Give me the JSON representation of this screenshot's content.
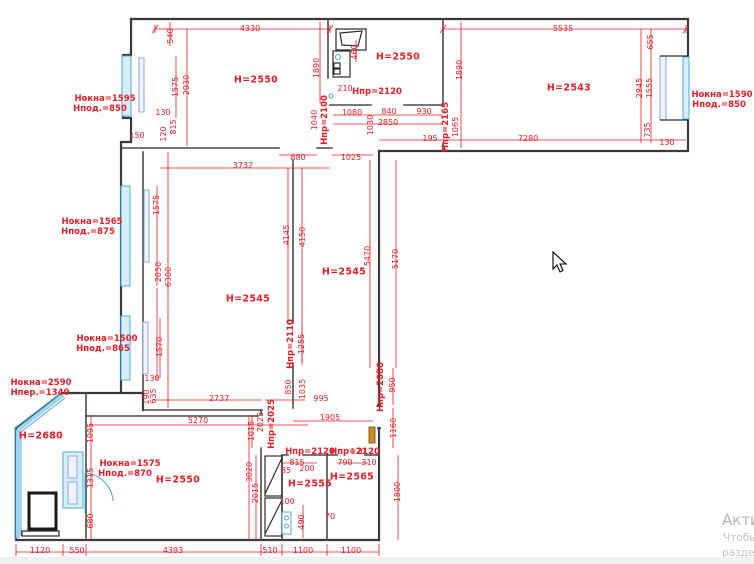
{
  "title": "apartment-measurement-floor-plan",
  "colors": {
    "dimension": "#ec1c24",
    "wall": "#3a3a3a",
    "window": "#49a8dc",
    "door_leaf": "#d28a1e",
    "watermark": "#b2b6ba"
  },
  "watermark": {
    "line1": "Актива",
    "line2": "Чтобы ак",
    "line3": "раздел \"П"
  },
  "labels": [
    [
      "4330",
      250,
      29,
      0,
      "dim"
    ],
    [
      "5535",
      563,
      29,
      0,
      "dim"
    ],
    [
      "540",
      171,
      36,
      1,
      "dim"
    ],
    [
      "655",
      651,
      42,
      1,
      "dim"
    ],
    [
      "1575",
      176,
      87,
      1,
      "dim"
    ],
    [
      "2930",
      187,
      85,
      1,
      "dim"
    ],
    [
      "H=2550",
      256,
      80,
      0,
      "room"
    ],
    [
      "1890",
      317,
      68,
      1,
      "dim"
    ],
    [
      "460",
      355,
      52,
      1,
      "dim"
    ],
    [
      "210",
      345,
      89,
      0,
      "dim"
    ],
    [
      "H=2550",
      398,
      57,
      0,
      "room"
    ],
    [
      "Hпр=2120",
      377,
      92,
      0,
      "door"
    ],
    [
      "1890",
      460,
      70,
      1,
      "dim"
    ],
    [
      "H=2543",
      569,
      88,
      0,
      "room"
    ],
    [
      "2945",
      640,
      88,
      1,
      "dim"
    ],
    [
      "1555",
      650,
      88,
      1,
      "dim"
    ],
    [
      "735",
      648,
      130,
      1,
      "dim"
    ],
    [
      "130",
      667,
      143,
      0,
      "dim"
    ],
    [
      "Нокна=1595",
      105,
      99,
      0,
      "win"
    ],
    [
      "Hпод.=850",
      100,
      109,
      0,
      "win"
    ],
    [
      "Нокна=1590",
      722,
      95,
      0,
      "win"
    ],
    [
      "Hпод.=850",
      719,
      105,
      0,
      "win"
    ],
    [
      "130",
      163,
      113,
      0,
      "dim"
    ],
    [
      "815",
      174,
      127,
      1,
      "dim"
    ],
    [
      "150",
      137,
      136,
      0,
      "dim"
    ],
    [
      "120",
      164,
      134,
      1,
      "dim"
    ],
    [
      "1040",
      315,
      120,
      1,
      "dim"
    ],
    [
      "Hпр=2100",
      325,
      120,
      1,
      "door"
    ],
    [
      "1080",
      352,
      113,
      0,
      "dim"
    ],
    [
      "840",
      389,
      112,
      0,
      "dim"
    ],
    [
      "930",
      424,
      112,
      0,
      "dim"
    ],
    [
      "2850",
      388,
      123,
      0,
      "dim"
    ],
    [
      "1030",
      371,
      125,
      1,
      "dim"
    ],
    [
      "195",
      430,
      139,
      0,
      "dim"
    ],
    [
      "Hпр=2165",
      446,
      127,
      1,
      "door"
    ],
    [
      "1065",
      456,
      127,
      1,
      "dim"
    ],
    [
      "7280",
      528,
      139,
      0,
      "dim"
    ],
    [
      "880",
      298,
      158,
      0,
      "dim"
    ],
    [
      "1025",
      351,
      158,
      0,
      "dim"
    ],
    [
      "3732",
      243,
      166,
      0,
      "dim"
    ],
    [
      "Нокна=1565",
      92,
      222,
      0,
      "win"
    ],
    [
      "Hпод.=875",
      88,
      232,
      0,
      "win"
    ],
    [
      "1575",
      157,
      205,
      1,
      "dim"
    ],
    [
      "2050",
      159,
      272,
      1,
      "dim"
    ],
    [
      "6300",
      169,
      277,
      1,
      "dim"
    ],
    [
      "4145",
      287,
      235,
      1,
      "dim"
    ],
    [
      "4150",
      303,
      237,
      1,
      "dim"
    ],
    [
      "5470",
      368,
      256,
      1,
      "dim"
    ],
    [
      "5170",
      396,
      259,
      1,
      "dim"
    ],
    [
      "H=2545",
      344,
      272,
      0,
      "room"
    ],
    [
      "H=2545",
      248,
      299,
      0,
      "room"
    ],
    [
      "Нокна=1500",
      107,
      339,
      0,
      "win"
    ],
    [
      "Hпод.=865",
      103,
      349,
      0,
      "win"
    ],
    [
      "1570",
      160,
      347,
      1,
      "dim"
    ],
    [
      "130",
      152,
      379,
      0,
      "dim"
    ],
    [
      "Hпр=2110",
      291,
      344,
      1,
      "door"
    ],
    [
      "1255",
      302,
      344,
      1,
      "dim"
    ],
    [
      "850",
      289,
      387,
      1,
      "dim"
    ],
    [
      "1035",
      303,
      389,
      1,
      "dim"
    ],
    [
      "190",
      147,
      397,
      1,
      "dim"
    ],
    [
      "635",
      154,
      396,
      1,
      "dim"
    ],
    [
      "Нокна=2590",
      41,
      383,
      0,
      "win"
    ],
    [
      "Hпер.=1340",
      40,
      393,
      0,
      "win"
    ],
    [
      "2737",
      219,
      399,
      0,
      "dim"
    ],
    [
      "995",
      321,
      399,
      0,
      "dim"
    ],
    [
      "5270",
      198,
      421,
      0,
      "dim"
    ],
    [
      "1905",
      330,
      418,
      0,
      "dim"
    ],
    [
      "Hпр=2080",
      381,
      387,
      1,
      "door"
    ],
    [
      "950",
      393,
      385,
      1,
      "dim"
    ],
    [
      "1160",
      394,
      428,
      1,
      "dim"
    ],
    [
      "120",
      358,
      452,
      0,
      "dim"
    ],
    [
      "2025",
      261,
      422,
      1,
      "dim"
    ],
    [
      "Hпр=2025",
      272,
      424,
      1,
      "door"
    ],
    [
      "1015",
      252,
      431,
      1,
      "dim"
    ],
    [
      "H=2680",
      41,
      436,
      0,
      "room"
    ],
    [
      "Нокна=1575",
      130,
      464,
      0,
      "win"
    ],
    [
      "Hпод.=870",
      125,
      474,
      0,
      "win"
    ],
    [
      "1095",
      91,
      433,
      1,
      "dim"
    ],
    [
      "1315",
      91,
      478,
      1,
      "dim"
    ],
    [
      "680",
      91,
      521,
      1,
      "dim"
    ],
    [
      "3020",
      250,
      472,
      1,
      "dim"
    ],
    [
      "2015",
      256,
      493,
      1,
      "dim"
    ],
    [
      "Hпр=2120",
      310,
      452,
      0,
      "door"
    ],
    [
      "Hпр=2120",
      355,
      452,
      0,
      "door"
    ],
    [
      "815",
      297,
      463,
      0,
      "dim"
    ],
    [
      "85",
      286,
      471,
      0,
      "dim"
    ],
    [
      "200",
      307,
      469,
      0,
      "dim"
    ],
    [
      "790",
      345,
      463,
      0,
      "dim"
    ],
    [
      "310",
      369,
      463,
      0,
      "dim"
    ],
    [
      "H=2550",
      178,
      480,
      0,
      "room"
    ],
    [
      "H=2555",
      310,
      484,
      0,
      "room"
    ],
    [
      "H=2565",
      352,
      477,
      0,
      "room"
    ],
    [
      "100",
      287,
      502,
      0,
      "dim"
    ],
    [
      "490",
      302,
      522,
      1,
      "dim"
    ],
    [
      "70",
      330,
      517,
      0,
      "dim"
    ],
    [
      "1800",
      398,
      492,
      1,
      "dim"
    ],
    [
      "1120",
      40,
      551,
      0,
      "dim"
    ],
    [
      "550",
      77,
      551,
      0,
      "dim"
    ],
    [
      "4393",
      173,
      551,
      0,
      "dim"
    ],
    [
      "510",
      270,
      551,
      0,
      "dim"
    ],
    [
      "1100",
      303,
      551,
      0,
      "dim"
    ],
    [
      "1100",
      351,
      551,
      0,
      "dim"
    ]
  ]
}
